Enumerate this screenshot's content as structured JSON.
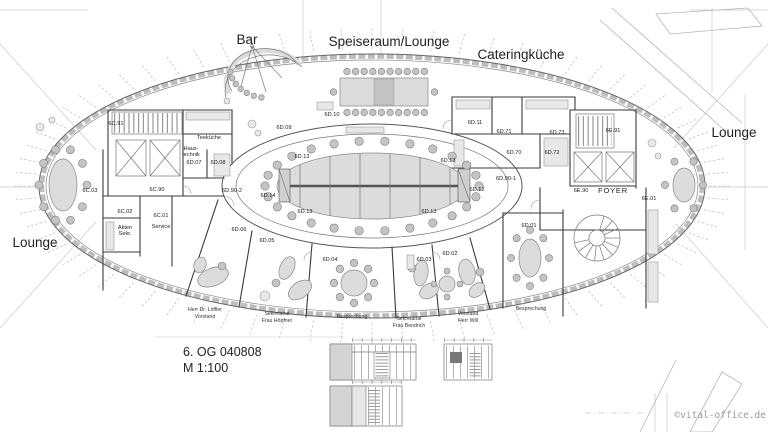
{
  "areas": {
    "bar": "Bar",
    "speiseraum": "Speiseraum/Lounge",
    "catering": "Cateringküche",
    "lounge_right": "Lounge",
    "lounge_left": "Lounge"
  },
  "rooms": {
    "c91": "6C.91",
    "c90": "6C.90",
    "c03": "6C.03",
    "c02": "6C.02",
    "c01": "6C.01",
    "d90_2": "6D.90-2",
    "d90_1": "6D.90-1",
    "d07": "6D.07",
    "d08": "6D.08",
    "d06": "6D.06",
    "d05": "6D.05",
    "d04": "6D.04",
    "d03": "6D.03",
    "d02": "6D.02",
    "d01": "6D.01",
    "d09": "6D.09",
    "d10": "6D.10",
    "d11": "6D.11",
    "d71": "6D.71",
    "d73": "6D.73",
    "d70": "6D.70",
    "d72": "6D.72",
    "d12": "6D.12",
    "d13": "6D.13",
    "d14": "6D.14",
    "e91": "6E.91",
    "e90": "6E.90",
    "foyer": "FOYER",
    "e01": "6E.01",
    "teekueche": "Teeküche",
    "haustechnik_1": "Haus-",
    "haustechnik_2": "technik",
    "akten_1": "Akten",
    "akten_2": "Sekr.",
    "service": "Service"
  },
  "names": {
    "loeffler_1": "Herr Dr. Löffler",
    "loeffler_2": "Vorstand",
    "hoepfner_1": "Sekretariat",
    "hoepfner_2": "Frau Höpfner",
    "besprechung_left": "Besprechung",
    "bendrich_1": "Sekretariat",
    "bendrich_2": "Frau Bendrich",
    "will_1": "Vorstand",
    "will_2": "Herr Will",
    "besprechung_right": "Besprechung"
  },
  "title_block": {
    "drawing": "6. OG 040808",
    "scale": "M 1:100"
  },
  "watermark": "©vital-office.de",
  "colors": {
    "wall": "#3a3a3a",
    "facade": "#bdbdbd",
    "furniture_fill": "#dcdcdc",
    "label": "#222222",
    "watermark_gray": "#9a9a9a"
  }
}
